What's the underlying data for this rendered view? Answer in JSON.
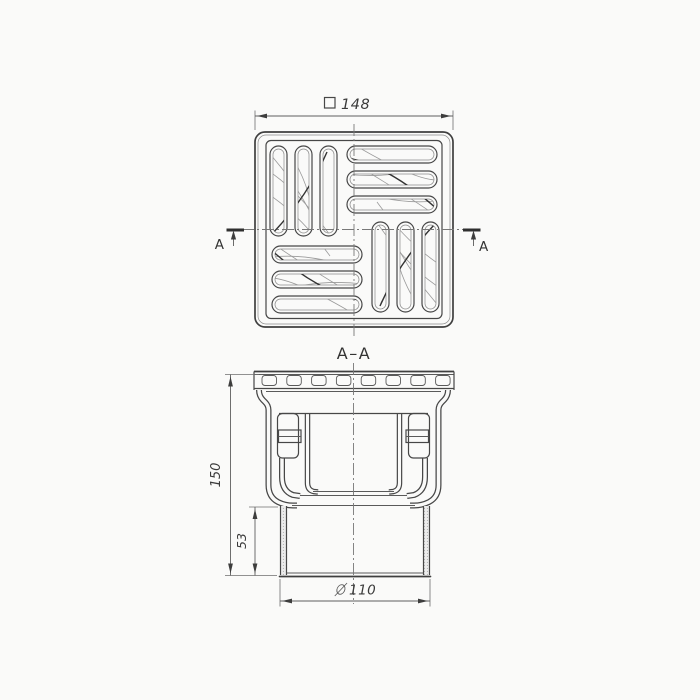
{
  "page": {
    "background_color": "#fafaf9",
    "line_color": "#474747",
    "hatch_color": "#b3b3b3"
  },
  "top_view": {
    "description": "square drain grate, plan view, pinwheel slot pattern",
    "width_dimension": {
      "symbol": "□",
      "value": "148"
    },
    "cut_marker_left": "A",
    "cut_marker_right": "A"
  },
  "section_view": {
    "title": "A–A",
    "overall_height": "150",
    "outlet_height": "53",
    "outlet_diameter": {
      "symbol": "∅",
      "value": "110"
    }
  }
}
